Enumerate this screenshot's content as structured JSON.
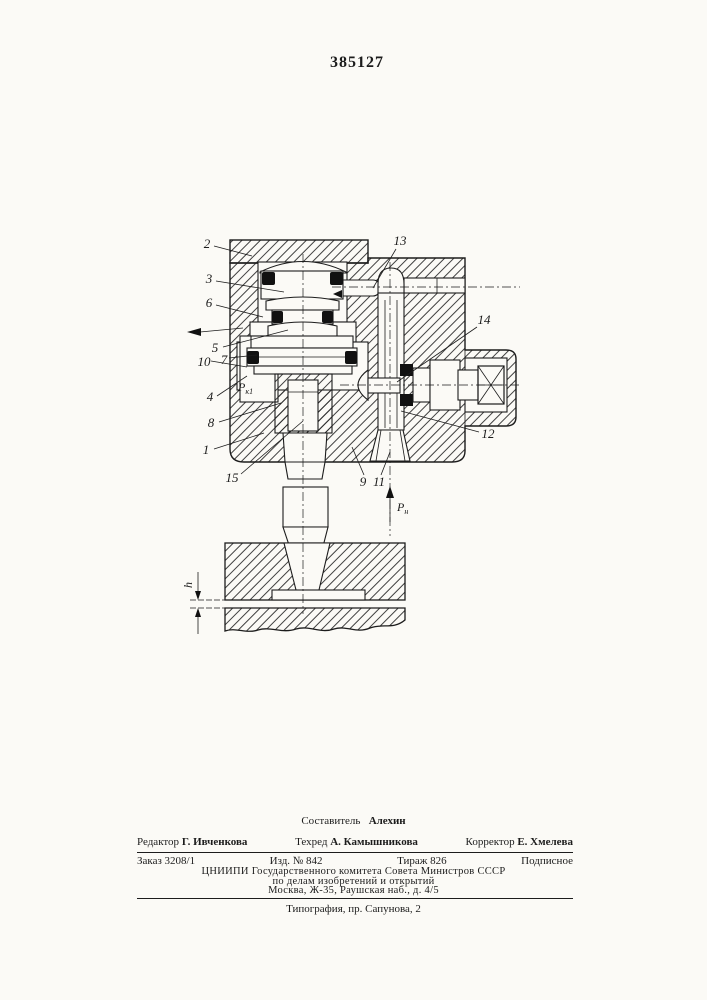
{
  "page": {
    "patent_number": "385127"
  },
  "figure": {
    "part_labels": {
      "1": "1",
      "2": "2",
      "3": "3",
      "4": "4",
      "5": "5",
      "6": "6",
      "7": "7",
      "8": "8",
      "9": "9",
      "10": "10",
      "11": "11",
      "12": "12",
      "13": "13",
      "14": "14",
      "15": "15"
    },
    "annotations": {
      "chamber_pressure_base": "Р",
      "chamber_pressure_sub": "к1",
      "supply_pressure_base": "Р",
      "supply_pressure_sub": "н",
      "gap": "h"
    }
  },
  "footer": {
    "compiler_label": "Составитель",
    "compiler_name": "Алехин",
    "editor_label": "Редактор",
    "editor_name": "Г. Ивченкова",
    "techred_label": "Техред",
    "techred_name": "А. Камышникова",
    "corrector_label": "Корректор",
    "corrector_name": "Е. Хмелева",
    "order_no": "Заказ 3208/1",
    "izd_no": "Изд. № 842",
    "tirazh": "Тираж 826",
    "podpisnoe": "Подписное",
    "org_line1": "ЦНИИПИ Государственного комитета Совета Министров СССР",
    "org_line2": "по делам изобретений и открытий",
    "org_line3": "Москва, Ж-35, Раушская наб., д. 4/5",
    "printer_line": "Типография, пр. Сапунова, 2"
  }
}
